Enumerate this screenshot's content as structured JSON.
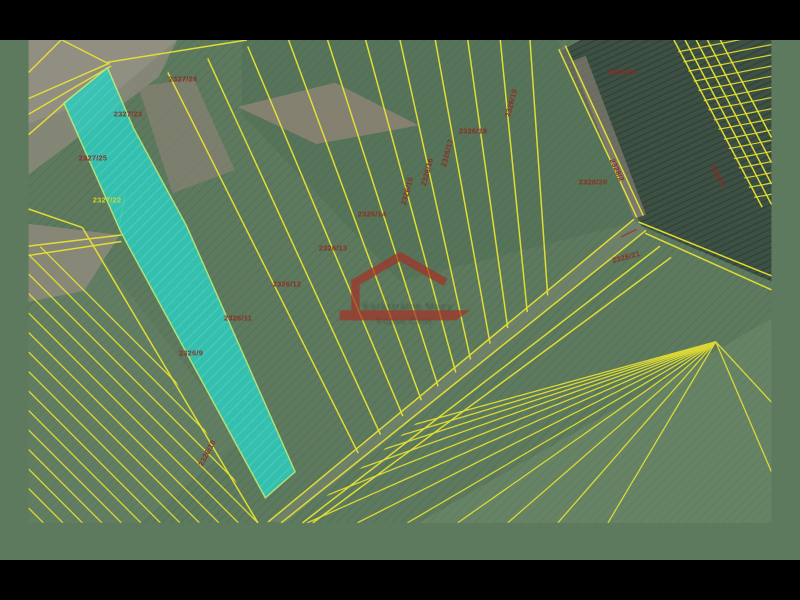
{
  "scene": {
    "title": "Cadastral parcel map over orthophoto",
    "view": "aerial-orthophoto-with-parcel-overlay"
  },
  "colors": {
    "parcel_line_yellow": "#e8e332",
    "selected_parcel_cyan": "#2fcabb",
    "selected_parcel_edge": "#b9ef76",
    "label_red": "#8e2a20",
    "label_yellow": "#d6d92e",
    "watermark_red": "#a33327",
    "field_green": "#5d7a5f",
    "dark_field": "#3d5044",
    "bare_soil": "#8d8476",
    "letterbox": "#000000"
  },
  "watermark": {
    "line1": "Katastrálne Mapy",
    "line2": "Kúpne Ceny"
  },
  "parcel_labels": [
    {
      "text": "2327/24",
      "x": 183,
      "y": 79,
      "rot": 0,
      "color": "red"
    },
    {
      "text": "2327/23",
      "x": 128,
      "y": 114,
      "rot": 0,
      "color": "red"
    },
    {
      "text": "2327/25",
      "x": 93,
      "y": 158,
      "rot": 0,
      "color": "red"
    },
    {
      "text": "2327/22",
      "x": 107,
      "y": 200,
      "rot": 0,
      "color": "yellow"
    },
    {
      "text": "2330/24",
      "x": 622,
      "y": 72,
      "rot": 0,
      "color": "red"
    },
    {
      "text": "2326/19",
      "x": 511,
      "y": 103,
      "rot": -75,
      "color": "red"
    },
    {
      "text": "2326/18",
      "x": 473,
      "y": 131,
      "rot": 0,
      "color": "red"
    },
    {
      "text": "2328/20",
      "x": 593,
      "y": 182,
      "rot": 0,
      "color": "red"
    },
    {
      "text": "2328/2",
      "x": 617,
      "y": 170,
      "rot": 65,
      "color": "red"
    },
    {
      "text": "2328/21",
      "x": 626,
      "y": 257,
      "rot": -15,
      "color": "red"
    },
    {
      "text": "2326/17",
      "x": 447,
      "y": 153,
      "rot": -75,
      "color": "red"
    },
    {
      "text": "2326/16",
      "x": 427,
      "y": 172,
      "rot": -75,
      "color": "red"
    },
    {
      "text": "2326/15",
      "x": 407,
      "y": 191,
      "rot": -75,
      "color": "red"
    },
    {
      "text": "2326/14",
      "x": 372,
      "y": 214,
      "rot": 0,
      "color": "red"
    },
    {
      "text": "2326/13",
      "x": 333,
      "y": 248,
      "rot": 0,
      "color": "red"
    },
    {
      "text": "2326/12",
      "x": 287,
      "y": 284,
      "rot": 0,
      "color": "red"
    },
    {
      "text": "2326/11",
      "x": 238,
      "y": 318,
      "rot": 0,
      "color": "red"
    },
    {
      "text": "2326/9",
      "x": 191,
      "y": 353,
      "rot": 0,
      "color": "red"
    },
    {
      "text": "2326/10",
      "x": 207,
      "y": 453,
      "rot": -62,
      "color": "red"
    },
    {
      "text": "2330/2",
      "x": 718,
      "y": 176,
      "rot": 62,
      "color": "red"
    }
  ]
}
